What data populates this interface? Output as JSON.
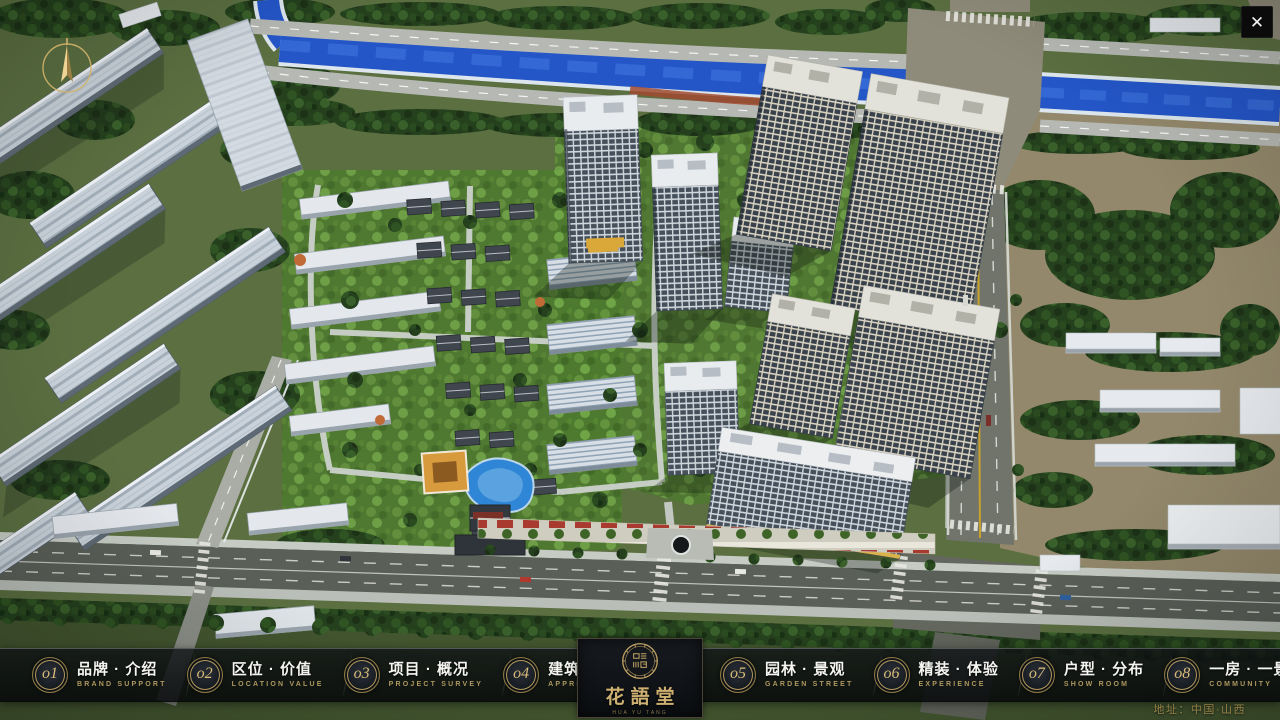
{
  "window": {
    "close_glyph": "✕"
  },
  "nav": {
    "items": [
      {
        "number": "o1",
        "label": "品牌 · 介绍",
        "subtitle": "BRAND SUPPORT"
      },
      {
        "number": "o2",
        "label": "区位 · 价值",
        "subtitle": "LOCATION VALUE"
      },
      {
        "number": "o3",
        "label": "项目 · 概况",
        "subtitle": "PROJECT SURVEY"
      },
      {
        "number": "o4",
        "label": "建筑 · 鉴赏",
        "subtitle": "APPRECIATION"
      },
      {
        "number": "o5",
        "label": "园林 · 景观",
        "subtitle": "GARDEN STREET"
      },
      {
        "number": "o6",
        "label": "精装 · 体验",
        "subtitle": "EXPERIENCE"
      },
      {
        "number": "o7",
        "label": "户型 · 分布",
        "subtitle": "SHOW ROOM"
      },
      {
        "number": "o8",
        "label": "一房 · 一景",
        "subtitle": "COMMUNITY"
      }
    ]
  },
  "logo": {
    "title": "花語堂",
    "subtitle": "HUA YU TANG"
  },
  "footer": {
    "address": "地址：中国·山西"
  },
  "colors": {
    "accent_gold": "#c7ab6a",
    "navbar_bg": "rgba(10,13,16,0.82)",
    "river_blue": "#2456c8",
    "close_btn_bg": "#0b0b0b"
  }
}
